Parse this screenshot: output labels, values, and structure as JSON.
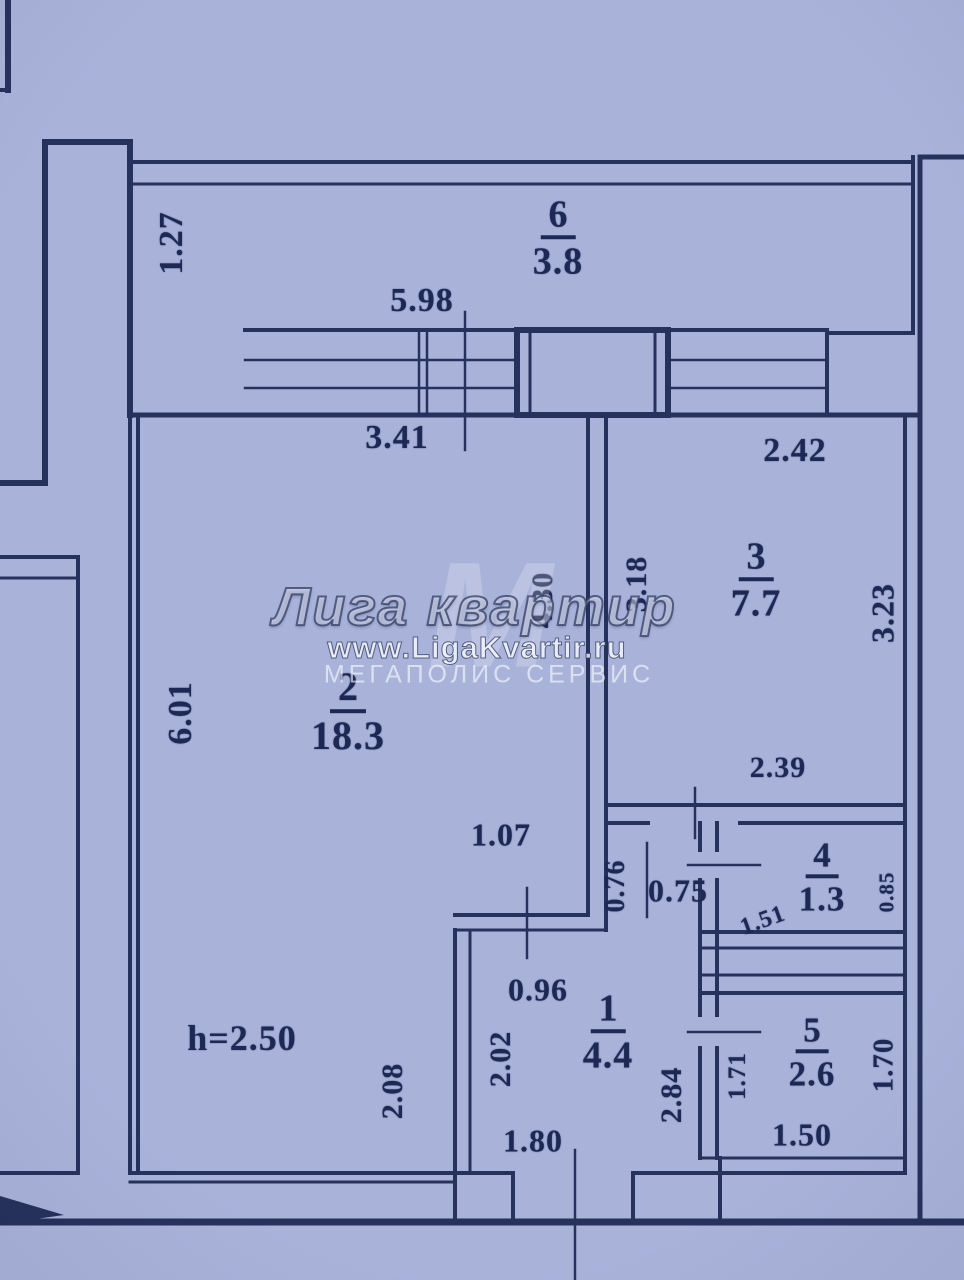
{
  "meta": {
    "type": "apartment-floor-plan",
    "ceiling_height": "h=2.50"
  },
  "palette": {
    "background": "#a9b3da",
    "wall_line": "#26315c",
    "label_text": "#1d2854",
    "watermark": "rgba(248,250,255,0.8)"
  },
  "watermark": {
    "monogram": "М",
    "title": "Лига квартир",
    "url": "www.LigaKvartir.ru",
    "subtitle": "МЕГАПОЛИС СЕРВИС"
  },
  "rooms": [
    {
      "number": "6",
      "area": "3.8"
    },
    {
      "number": "2",
      "area": "18.3"
    },
    {
      "number": "3",
      "area": "7.7"
    },
    {
      "number": "4",
      "area": "1.3"
    },
    {
      "number": "5",
      "area": "2.6"
    },
    {
      "number": "1",
      "area": "4.4"
    }
  ],
  "dimensions": [
    "1.27",
    "5.98",
    "3.41",
    "2.42",
    "6.01",
    "4.30",
    "3.18",
    "3.23",
    "2.39",
    "1.07",
    "0.76",
    "0.75",
    "1.51",
    "0.85",
    "0.96",
    "2.02",
    "2.08",
    "h=2.50",
    "1.80",
    "2.84",
    "1.71",
    "1.70",
    "1.50"
  ]
}
